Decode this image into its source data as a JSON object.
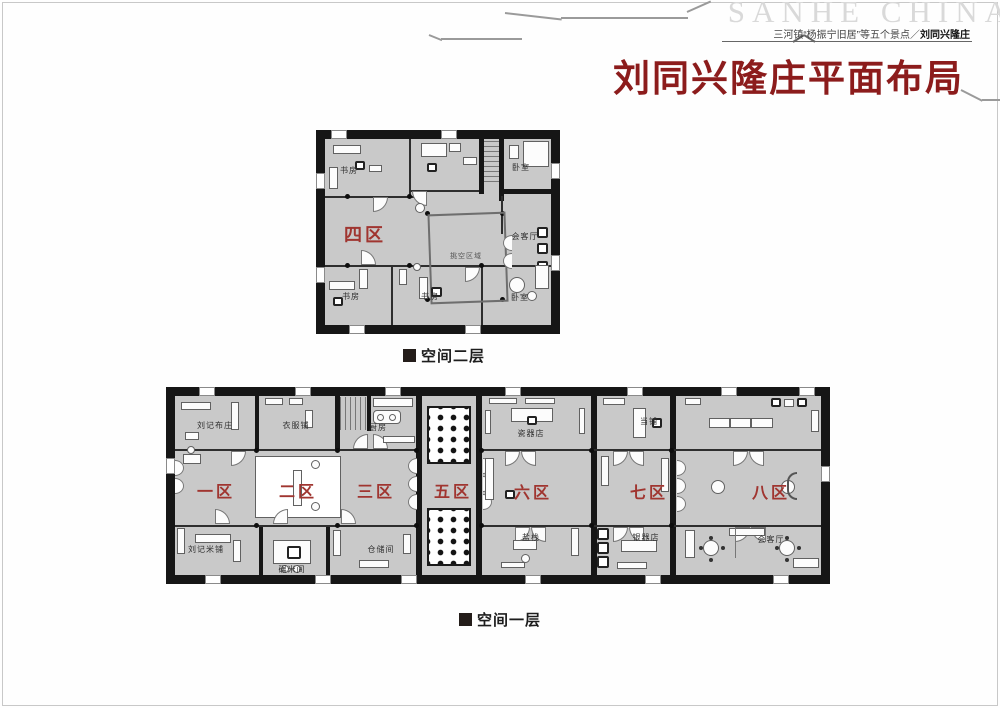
{
  "page": {
    "brand": "SANHE CHINA",
    "breadcrumb_prefix": "三河镇“杨振宁旧居”等五个景点／",
    "breadcrumb_current": "刘同兴隆庄",
    "title": "刘同兴隆庄平面布局"
  },
  "floor2": {
    "caption": "空间二层",
    "zone": "四区",
    "rooms": {
      "study_top": "书房",
      "bedroom_top": "卧室",
      "void_area": "挑空区域",
      "reception": "会客厅",
      "study_bottom_left": "书房",
      "study_bottom_mid": "书房",
      "bedroom_bottom": "卧室"
    }
  },
  "floor1": {
    "caption": "空间一层",
    "zones": [
      "一区",
      "二区",
      "三区",
      "五区",
      "六区",
      "七区",
      "八区"
    ],
    "top_rooms": [
      "刘记布庄",
      "衣服铺",
      "厨房",
      "瓷器店",
      "当铺"
    ],
    "bottom_rooms": [
      "刘记米铺",
      "碾米间",
      "仓储间",
      "盐栈",
      "银器店",
      "会客厅"
    ]
  },
  "colors": {
    "title_red": "#8C1C1C",
    "zone_red": "#A03530",
    "plan_fill": "#C9C9C9",
    "wall": "#161616",
    "brand_gray": "#D9D9D9"
  }
}
